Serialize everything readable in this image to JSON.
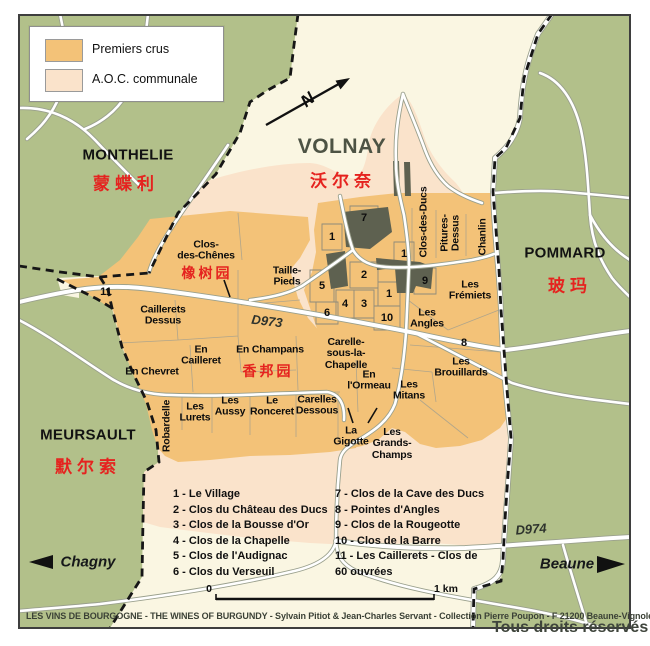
{
  "legend": {
    "premiers_crus": "Premiers crus",
    "aoc_communale": "A.O.C. communale"
  },
  "communes": {
    "monthelie": {
      "name": "MONTHELIE",
      "cn": "蒙蝶利"
    },
    "volnay": {
      "name": "VOLNAY",
      "cn": "沃尔奈"
    },
    "pommard": {
      "name": "POMMARD",
      "cn": "玻玛"
    },
    "meursault": {
      "name": "MEURSAULT",
      "cn": "默尔索"
    }
  },
  "vineyards": {
    "clos_des_chenes": "Clos-\ndes-Chênes",
    "clos_des_chenes_cn": "橡树园",
    "taille_pieds": "Taille-\nPieds",
    "caillerets_dessus": "Caillerets\nDessus",
    "en_cailleret": "En\nCailleret",
    "en_chevret": "En Chevret",
    "en_champans": "En Champans",
    "en_champans_cn": "香邦园",
    "carelle": "Carelle-\nsous-la-\nChapelle",
    "en_l_ormeau": "En\nl'Ormeau",
    "les_mitans": "Les\nMitans",
    "les_brouillards": "Les\nBrouillards",
    "les_angles": "Les\nAngles",
    "les_fremiets": "Les\nFrémiets",
    "clos_des_ducs": "Clos-des-Ducs",
    "pitures_dessus": "Pitures-\nDessus",
    "chanlin": "Chanlin",
    "les_lurets": "Les\nLurets",
    "les_aussy": "Les\nAussy",
    "le_ronceret": "Le\nRonceret",
    "carelles_dessous": "Carelles\nDessous",
    "robardelle": "Robardelle",
    "la_gigotte": "La\nGigotte",
    "grands_champs": "Les\nGrands-\nChamps"
  },
  "parcels": [
    "7",
    "1",
    "1",
    "2",
    "9",
    "5",
    "1",
    "4",
    "3",
    "6",
    "10",
    "8",
    "11"
  ],
  "index_list": {
    "left": [
      "1 - Le Village",
      "2 - Clos du Château des Ducs",
      "3 - Clos de la Bousse d'Or",
      "4 - Clos de la Chapelle",
      "5 - Clos de l'Audignac",
      "6 - Clos du Verseuil"
    ],
    "right": [
      "7 - Clos de la Cave des Ducs",
      "8 - Pointes d'Angles",
      "9 - Clos de la Rougeotte",
      "10 - Clos de la Barre",
      "11 - Les Caillerets - Clos de",
      "60 ouvrées"
    ]
  },
  "roads": {
    "d973": "D973",
    "d974": "D974"
  },
  "directions": {
    "west": "Chagny",
    "east": "Beaune"
  },
  "scale": {
    "start": "0",
    "end": "1 km"
  },
  "compass": {
    "north": "N"
  },
  "credit": "LES VINS DE BOURGOGNE - THE WINES OF BURGUNDY - Sylvain Pitiot & Jean-Charles Servant - Collection Pierre Poupon - F 21200 Beaune-Vignoles",
  "rights": "Tous droits réservés",
  "colors": {
    "premiers_crus": "#f3c278",
    "aoc_communale": "#fae3cb",
    "countryside_green": "#b2c08a",
    "commune_cream": "#faf6e2",
    "village_block": "#5e6150",
    "cjk_red": "#e5231f"
  }
}
